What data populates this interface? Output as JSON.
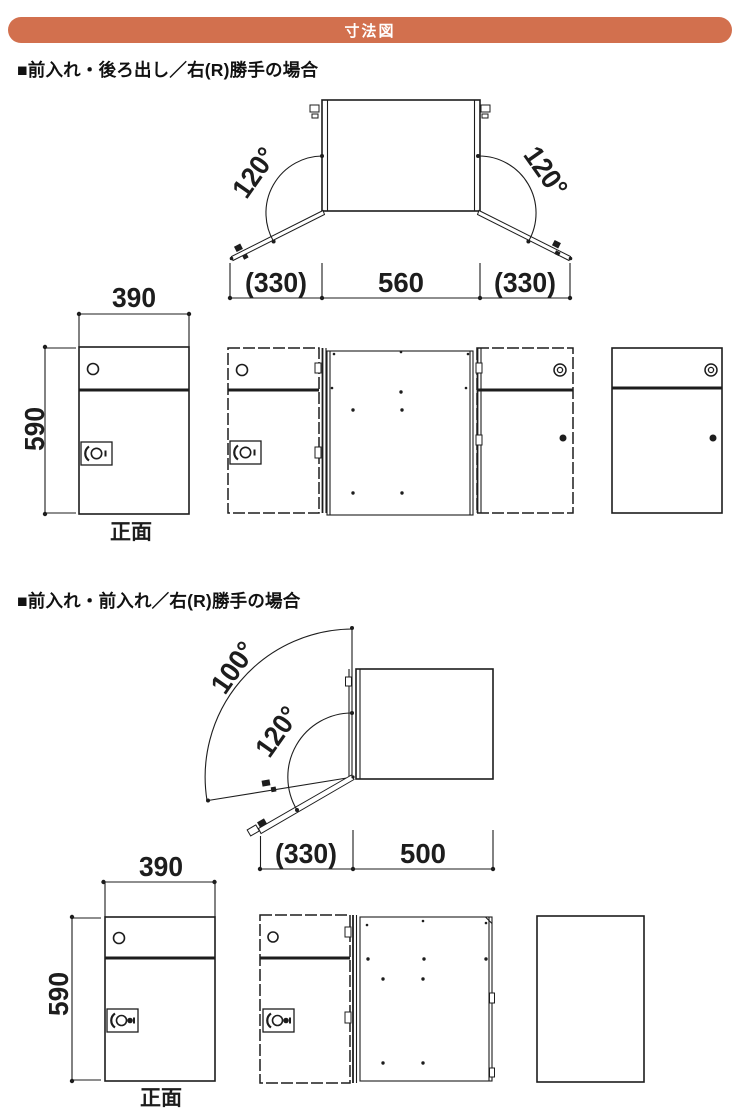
{
  "banner": {
    "title": "寸法図"
  },
  "colors": {
    "banner_bg": "#d2704e",
    "banner_text": "#ffffff",
    "ink": "#1d1d1d"
  },
  "sections": [
    {
      "heading": "■前入れ・後ろ出し／右(R)勝手の場合",
      "plan": {
        "angle_left": "120°",
        "angle_right": "120°",
        "dim_left": "(330)",
        "dim_center": "560",
        "dim_right": "(330)"
      },
      "front": {
        "width": "390",
        "height": "590",
        "caption": "正面"
      }
    },
    {
      "heading": "■前入れ・前入れ／右(R)勝手の場合",
      "plan": {
        "angle_outer": "100°",
        "angle_inner": "120°",
        "dim_left": "(330)",
        "dim_right": "500"
      },
      "front": {
        "width": "390",
        "height": "590",
        "caption": "正面"
      }
    }
  ]
}
